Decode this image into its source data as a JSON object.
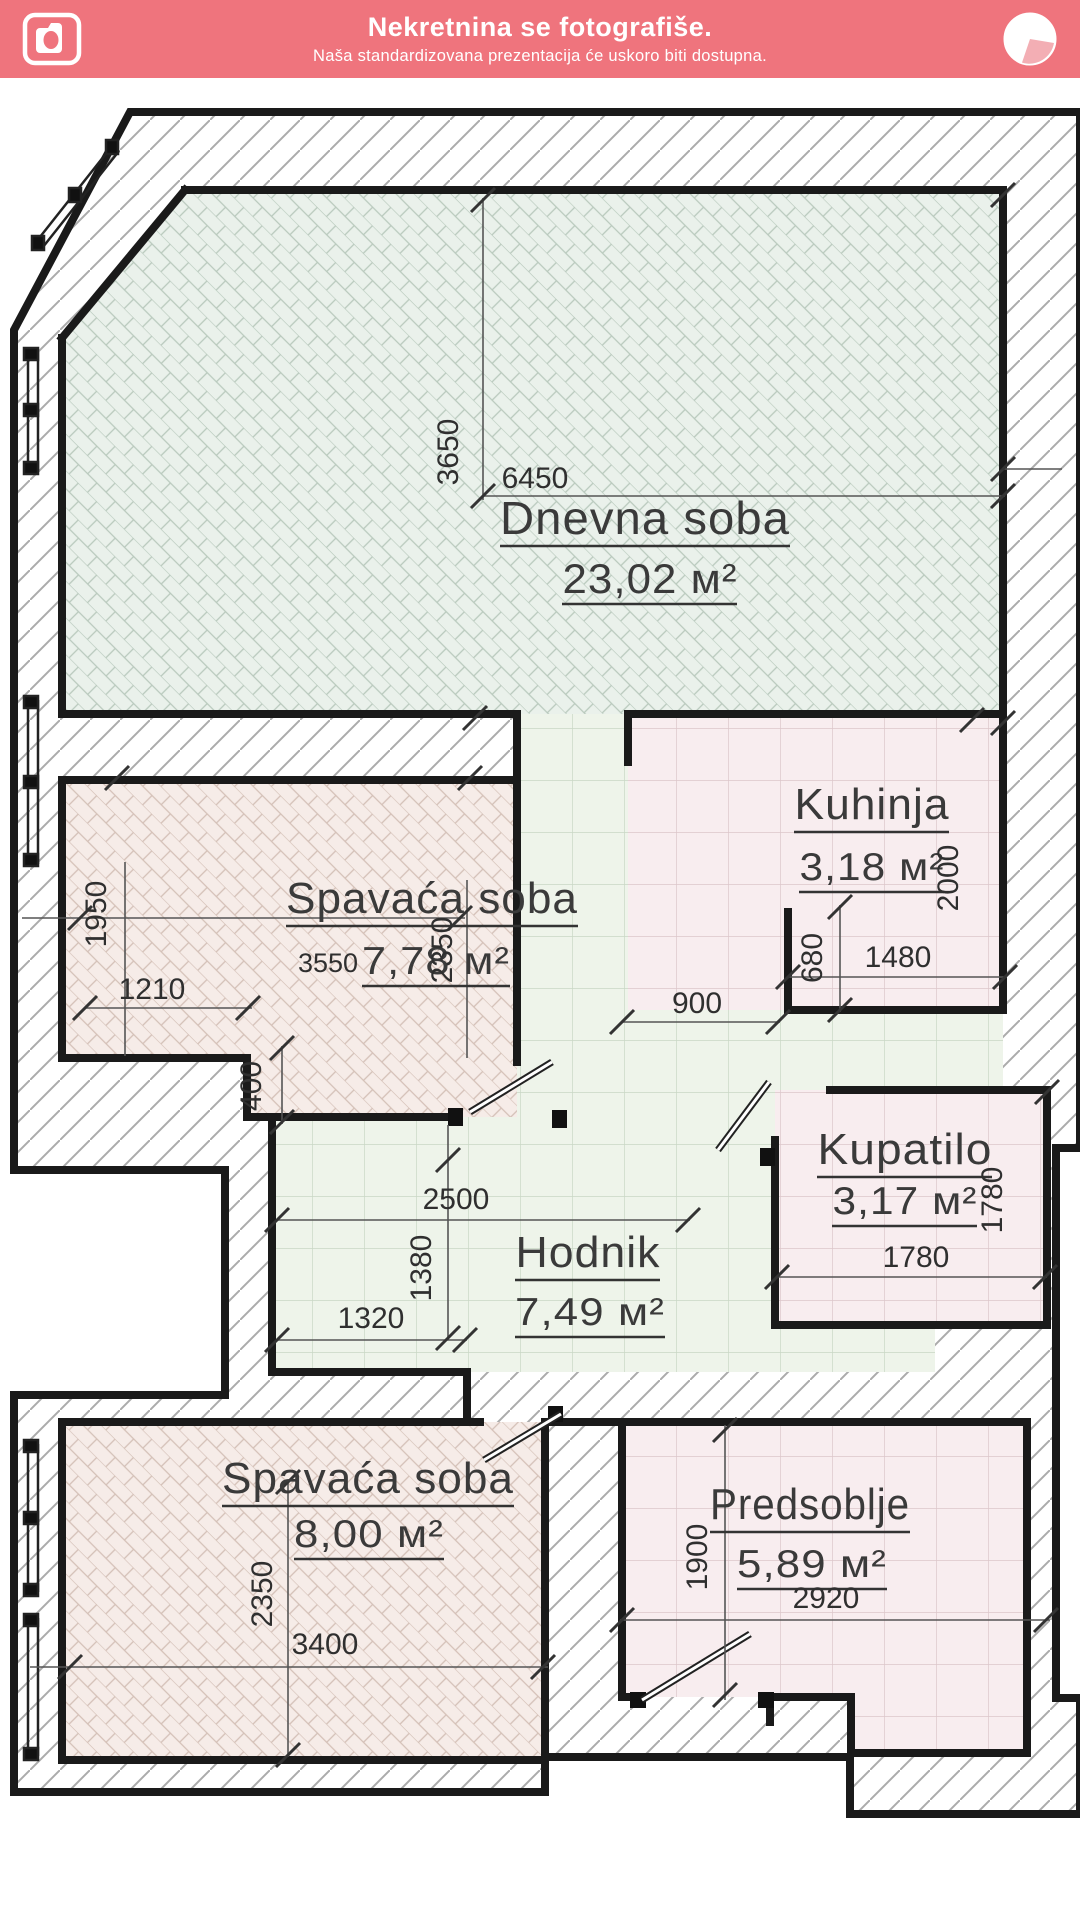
{
  "header": {
    "title": "Nekretnina se fotografiše.",
    "subtitle": "Naša standardizovana prezentacija će uskoro biti dostupna.",
    "accent_color": "#ef747d",
    "icons": {
      "left": "camera-icon",
      "right": "pie-progress-icon"
    }
  },
  "plan": {
    "rooms": [
      {
        "name": "Dnevna soba",
        "area": "23,02 м²"
      },
      {
        "name": "Spavaća soba",
        "area": "7,78 м²"
      },
      {
        "name": "Kuhinja",
        "area": "3,18 м²"
      },
      {
        "name": "Kupatilo",
        "area": "3,17 м²"
      },
      {
        "name": "Hodnik",
        "area": "7,49 м²"
      },
      {
        "name": "Spavaća soba",
        "area": "8,00 м²"
      },
      {
        "name": "Predsoblje",
        "area": "5,89 м²"
      }
    ],
    "dims": {
      "living_height": "3650",
      "living_width": "6450",
      "bed1_height": "1950",
      "bed1_width": "3550",
      "bed1_depth": "2350",
      "bed1_bottom": "1210",
      "bed1_step": "400",
      "hall_pass": "900",
      "kitchen_nook": "680",
      "kitchen_width": "1480",
      "kitchen_height": "2000",
      "hall_width": "2500",
      "hall_height": "1380",
      "hall_bottom": "1320",
      "bath_height": "1780",
      "bath_width": "1780",
      "bed2_height": "2350",
      "bed2_width": "3400",
      "entry_height": "1900",
      "entry_width": "2920"
    },
    "colors": {
      "wall": "#1a1a1a",
      "floor_green": "#eaf1eb",
      "floor_pink": "#f6ece8",
      "tile_green": "#eef4ea",
      "tile_pink": "#f8edef"
    }
  }
}
